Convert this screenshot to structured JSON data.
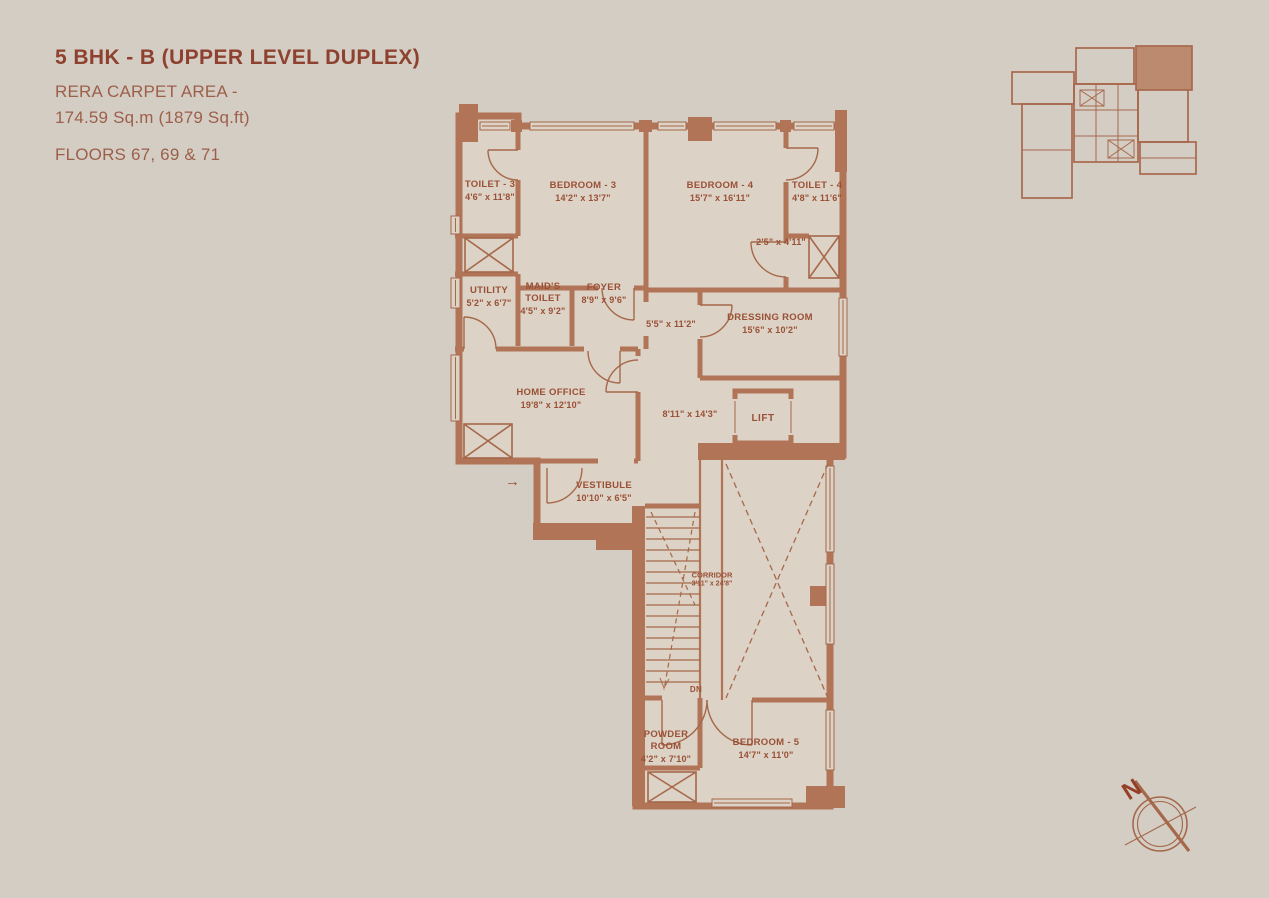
{
  "header": {
    "title": "5 BHK - B (UPPER LEVEL DUPLEX)",
    "rera_line1": "RERA CARPET AREA -",
    "rera_line2": "174.59 Sq.m (1879 Sq.ft)",
    "floors": "FLOORS 67, 69 & 71"
  },
  "colors": {
    "background": "#d3cdc4",
    "wall": "#b17456",
    "room_fill": "#dcd2c5",
    "thin_line": "#a6684a",
    "label_text": "#9a5036",
    "title_text": "#8f4130",
    "keyplan_highlight": "#bc8a6e"
  },
  "compass": {
    "label": "N"
  },
  "floor_plan": {
    "entry_arrow": "→",
    "rooms": [
      {
        "id": "toilet-3",
        "name": "TOILET - 3",
        "dims": "4'6\" x 11'8\"",
        "x": 490,
        "y": 191
      },
      {
        "id": "bedroom-3",
        "name": "BEDROOM - 3",
        "dims": "14'2\" x 13'7\"",
        "x": 583,
        "y": 192
      },
      {
        "id": "bedroom-4",
        "name": "BEDROOM - 4",
        "dims": "15'7\" x 16'11\"",
        "x": 720,
        "y": 192
      },
      {
        "id": "toilet-4",
        "name": "TOILET - 4",
        "dims": "4'8\" x 11'6\"",
        "x": 817,
        "y": 192
      },
      {
        "id": "niche",
        "name": "",
        "dims": "2'5\" x 4'11\"",
        "x": 781,
        "y": 242
      },
      {
        "id": "utility",
        "name": "UTILITY",
        "dims": "5'2\" x 6'7\"",
        "x": 489,
        "y": 297
      },
      {
        "id": "maids-toilet",
        "name": "MAID'S TOILET",
        "dims": "4'5\" x 9'2\"",
        "x": 543,
        "y": 299
      },
      {
        "id": "foyer",
        "name": "FOYER",
        "dims": "8'9\" x 9'6\"",
        "x": 604,
        "y": 294
      },
      {
        "id": "passage",
        "name": "",
        "dims": "5'5\" x 11'2\"",
        "x": 671,
        "y": 324
      },
      {
        "id": "dressing-room",
        "name": "DRESSING ROOM",
        "dims": "15'6\" x 10'2\"",
        "x": 770,
        "y": 324
      },
      {
        "id": "home-office",
        "name": "HOME OFFICE",
        "dims": "19'8\" x 12'10\"",
        "x": 551,
        "y": 399
      },
      {
        "id": "inner-corridor",
        "name": "",
        "dims": "8'11\" x 14'3\"",
        "x": 690,
        "y": 414
      },
      {
        "id": "lift",
        "name": "LIFT",
        "dims": "",
        "x": 763,
        "y": 419
      },
      {
        "id": "vestibule",
        "name": "VESTIBULE",
        "dims": "10'10\" x 6'5\"",
        "x": 604,
        "y": 492
      },
      {
        "id": "corridor",
        "name": "CORRIDOR",
        "dims": "3'11\" x 24'8\"",
        "x": 712,
        "y": 580
      },
      {
        "id": "stairs-dn",
        "name": "DN",
        "dims": "",
        "x": 696,
        "y": 690
      },
      {
        "id": "powder-room",
        "name": "POWDER ROOM",
        "dims": "4'2\" x 7'10\"",
        "x": 666,
        "y": 747
      },
      {
        "id": "bedroom-5",
        "name": "BEDROOM - 5",
        "dims": "14'7\" x 11'0\"",
        "x": 766,
        "y": 749
      }
    ]
  }
}
